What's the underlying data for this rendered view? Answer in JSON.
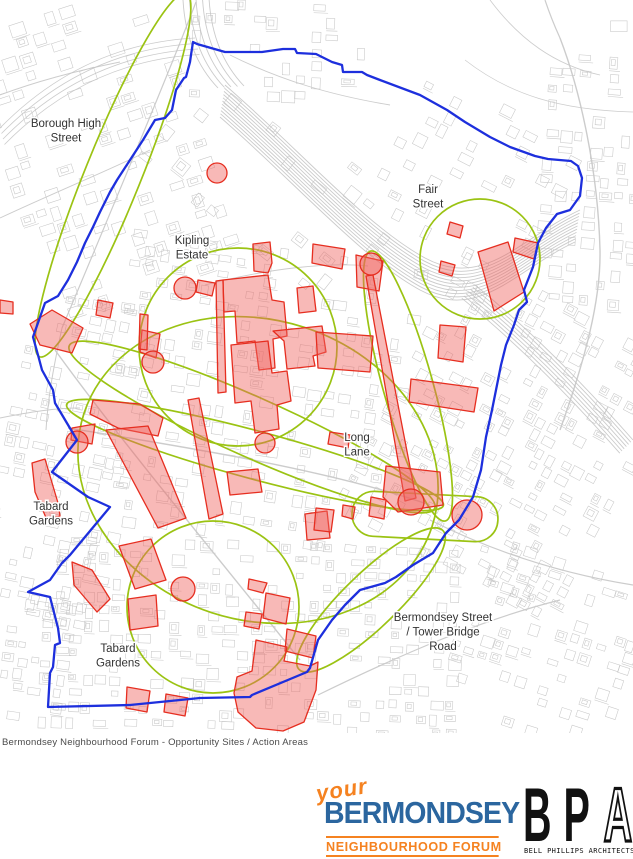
{
  "page": {
    "width": 633,
    "height": 859,
    "background": "#ffffff"
  },
  "caption": "Bermondsey Neighbourhood Forum - Opportunity Sites / Action Areas",
  "map": {
    "width": 633,
    "height": 733,
    "colors": {
      "boundary": "#1d2fdd",
      "action_area": "#9bc313",
      "site_stroke": "#e62e20",
      "site_fill": "rgba(240,100,95,0.45)",
      "street": "#c7c7c7",
      "road": "#c9c9c9",
      "rail": "#c2c2c2",
      "label": "#333333",
      "label_halo": "#ffffff"
    },
    "labels": [
      {
        "name": "borough-high-street",
        "x": 66,
        "y": 127,
        "lines": [
          "Borough High",
          "Street"
        ]
      },
      {
        "name": "fair-street",
        "x": 428,
        "y": 193,
        "lines": [
          "Fair",
          "Street"
        ]
      },
      {
        "name": "kipling-estate",
        "x": 192,
        "y": 244,
        "lines": [
          "Kipling",
          "Estate"
        ]
      },
      {
        "name": "long-lane",
        "x": 357,
        "y": 441,
        "lines": [
          "Long",
          "Lane"
        ]
      },
      {
        "name": "tabard-gardens-north",
        "x": 51,
        "y": 510,
        "lines": [
          "Tabard",
          "Gardens"
        ]
      },
      {
        "name": "tabard-gardens-south",
        "x": 118,
        "y": 652,
        "lines": [
          "Tabard",
          "Gardens"
        ]
      },
      {
        "name": "bermondsey-street-tower-bridge-road",
        "x": 443,
        "y": 621,
        "lines": [
          "Bermondsey Street",
          "/ Tower Bridge",
          "Road"
        ]
      }
    ],
    "boundary_points": "193,42 197,44 225,52 262,52 283,49 295,49 297,53 316,54 332,62 342,65 343,72 362,72 367,75 380,80 420,95 447,110 465,122 490,137 510,147 535,156 548,159 571,161 578,166 582,178 580,196 570,210 557,214 546,228 538,243 533,267 524,290 527,302 519,310 514,325 506,345 501,365 498,380 492,410 486,437 481,470 473,497 459,520 446,533 433,553 413,565 396,577 385,583 360,590 345,605 332,620 318,640 310,668 307,672 252,695 250,697 200,698 130,705 48,707 50,673 53,667 55,645 60,643 58,628 50,597 28,592 50,580 62,563 70,555 110,507 88,497 52,472 77,440 55,403 53,390 42,370 38,355 33,337 45,303 58,296 68,280 77,262 85,243 93,227 100,212 110,192 117,180 130,160 143,140 155,120 165,118 172,110 176,90 184,78 186,77 190,62 191,55",
    "action_areas": {
      "ellipses": [
        {
          "cx": 113,
          "cy": 175,
          "rx": 28,
          "ry": 196,
          "rot": 22
        },
        {
          "cx": 238,
          "cy": 347,
          "rx": 99,
          "ry": 99,
          "rot": 0
        },
        {
          "cx": 480,
          "cy": 259,
          "rx": 60,
          "ry": 60,
          "rot": 0
        },
        {
          "cx": 408,
          "cy": 386,
          "rx": 25,
          "ry": 140,
          "rot": -15.5
        },
        {
          "cx": 213,
          "cy": 607,
          "rx": 86,
          "ry": 86,
          "rot": 0
        },
        {
          "cx": 258,
          "cy": 470,
          "rx": 183,
          "ry": 150,
          "rot": 18
        },
        {
          "cx": 255,
          "cy": 455,
          "rx": 195,
          "ry": 24,
          "rot": 15
        },
        {
          "cx": 252,
          "cy": 427,
          "rx": 200,
          "ry": 30,
          "rot": 24
        },
        {
          "cx": 371,
          "cy": 600,
          "rx": 100,
          "ry": 27,
          "rot": -44
        }
      ],
      "stadiums": [
        {
          "x": 352,
          "y": 494,
          "w": 146,
          "h": 45,
          "r": 22,
          "rot": 3,
          "cx": 425,
          "cy": 516
        }
      ]
    },
    "sites": {
      "circles": [
        [
          217,
          173,
          10
        ],
        [
          185,
          288,
          11
        ],
        [
          153,
          362,
          11
        ],
        [
          77,
          442,
          11
        ],
        [
          265,
          443,
          10
        ],
        [
          371,
          264,
          11
        ],
        [
          411,
          502,
          13
        ],
        [
          467,
          515,
          15
        ],
        [
          183,
          589,
          12
        ]
      ],
      "polygons": [
        "M30,324L52,310L83,328L72,353L40,345Z",
        "M0,300L13,302L13,314L0,313Z",
        "M98,300L113,303L110,318L96,315Z",
        "M142,330L160,334L156,358L140,352Z",
        "M140,314L148,315L147,350L139,349Z",
        "M198,280L215,283L212,296L196,292Z",
        "M216,281L223,280L226,392L218,393Z",
        "M223,280L268,275L272,300L284,302L287,336L273,339L275,368L259,370L255,341L237,343L235,311L224,312Z",
        "M231,345L268,341L272,373L287,371L291,401L277,405L279,429L255,433L251,401L235,403Z",
        "M273,331L322,326L326,352L313,356L315,366L287,369L284,341Z",
        "M297,288L313,286L316,311L299,313Z",
        "M253,244L270,242L272,263L268,273L254,271Z",
        "M313,244L345,249L342,269L312,263Z",
        "M356,255L383,261L379,291L357,287Z",
        "M93,400L140,404L163,418L158,436L118,428L90,414Z",
        "M72,428L95,424L92,444L71,440Z",
        "M32,463L45,459L58,503L60,516L47,520L35,492Z",
        "M106,430L148,426L186,518L158,528Z",
        "M188,400L199,398L223,514L209,519Z",
        "M227,472L258,469L262,492L230,495Z",
        "M316,332L373,336L370,372L318,368Z",
        "M440,325L466,327L463,362L438,358Z",
        "M411,379L478,388L474,412L409,402Z",
        "M366,276L373,275L416,498L405,501Z",
        "M386,466L440,472L443,505L398,512L383,497Z",
        "M371,497L386,500L384,519L369,516Z",
        "M305,514L327,511L330,538L307,540Z",
        "M343,505L355,507L353,519L342,516Z",
        "M316,508L334,510L331,532L314,530Z",
        "M330,432L350,435L348,448L328,444Z",
        "M119,546L151,539L166,580L135,589Z",
        "M128,599L156,595L158,626L130,630Z",
        "M249,579L267,583L263,593L248,589Z",
        "M266,593L290,598L286,624L263,618Z",
        "M246,612L262,614L259,629L244,626Z",
        "M287,629L316,636L313,658L285,651Z",
        "M72,562L92,570L110,599L97,612L74,585Z",
        "M127,687L150,691L147,712L126,708Z",
        "M166,694L188,698L185,716L164,712Z",
        "M256,640L287,647L284,661L310,666L318,662L316,690L304,722L283,731L256,728L238,712L234,693L237,677L252,671Z",
        "M450,222L463,226L460,238L447,234Z",
        "M441,261L455,265L452,276L439,272Z",
        "M478,252L508,242L524,292L494,311Z",
        "M515,238L538,243L534,259L513,252Z"
      ]
    },
    "railways": [
      {
        "d": "M225,85 C300,150 365,225 425,258 C485,290 520,238 580,210",
        "n": 11,
        "dx": -0.5,
        "dy": 3.2,
        "w": 0.9
      },
      {
        "d": "M475,285 C530,330 580,380 633,440",
        "n": 7,
        "dx": -2.2,
        "dy": 2.2,
        "w": 0.9
      },
      {
        "d": "M183,0 C185,35 196,65 218,88",
        "n": 5,
        "dx": 6.5,
        "dy": -0.5,
        "w": 0.9
      },
      {
        "d": "M0,128 C55,72 120,42 195,38",
        "n": 4,
        "dx": 1.5,
        "dy": 5.5,
        "w": 0.8
      }
    ],
    "roads": [
      {
        "d": "M196,2 C170,70 120,190 62,328",
        "w": 1.2
      },
      {
        "d": "M62,328 C55,360 48,395 46,430",
        "w": 1.0
      },
      {
        "d": "M55,350 C120,440 220,560 300,660",
        "w": 1.4
      },
      {
        "d": "M68,428 C180,446 330,470 430,505",
        "w": 1.4
      },
      {
        "d": "M560,38 C580,90 598,170 600,250 C601,300 585,360 560,430",
        "w": 1.4
      },
      {
        "d": "M545,0 C550,15 555,27 560,38",
        "w": 1.2
      },
      {
        "d": "M230,55 C280,80 330,95 390,105",
        "w": 0.9
      },
      {
        "d": "M205,285 C270,268 330,262 368,266",
        "w": 0.9
      },
      {
        "d": "M430,520 C500,555 570,575 633,585",
        "w": 1.2
      },
      {
        "d": "M318,695 C400,655 480,620 560,600",
        "w": 1.2
      },
      {
        "d": "M0,418 C30,412 55,408 80,408",
        "w": 0.9
      },
      {
        "d": "M490,0 C520,40 555,65 600,75",
        "w": 0.8
      },
      {
        "d": "M465,60 C510,95 560,110 633,112",
        "w": 0.7
      },
      {
        "d": "M0,95 C40,80 80,70 120,62",
        "w": 0.9
      },
      {
        "d": "M0,218 C60,190 110,170 150,150",
        "w": 0.9
      }
    ],
    "street_zones": [
      [
        0,
        0,
        200,
        300,
        -18,
        17,
        0.45
      ],
      [
        190,
        0,
        180,
        100,
        2,
        15,
        0.3
      ],
      [
        150,
        115,
        240,
        130,
        38,
        17,
        0.22
      ],
      [
        390,
        95,
        170,
        150,
        27,
        16,
        0.3
      ],
      [
        540,
        55,
        93,
        250,
        4,
        15,
        0.45
      ],
      [
        470,
        0,
        163,
        95,
        0,
        20,
        0.08
      ],
      [
        0,
        295,
        125,
        320,
        12,
        15,
        0.45
      ],
      [
        110,
        245,
        290,
        300,
        8,
        15,
        0.32
      ],
      [
        385,
        290,
        248,
        290,
        28,
        14,
        0.5
      ],
      [
        455,
        555,
        178,
        175,
        18,
        14,
        0.45
      ],
      [
        40,
        540,
        420,
        190,
        2,
        14,
        0.45
      ],
      [
        0,
        600,
        60,
        130,
        8,
        14,
        0.4
      ]
    ]
  },
  "footer": {
    "forum_logo": {
      "your": "your",
      "name": "BERMONDSEY",
      "subtitle": "NEIGHBOURHOOD FORUM",
      "orange": "#f58220",
      "blue": "#2b669f"
    },
    "bpa_logo": {
      "initials_solid": "BP",
      "initial_outline": "A",
      "name": "BELL PHILLIPS ARCHITECTS"
    }
  }
}
